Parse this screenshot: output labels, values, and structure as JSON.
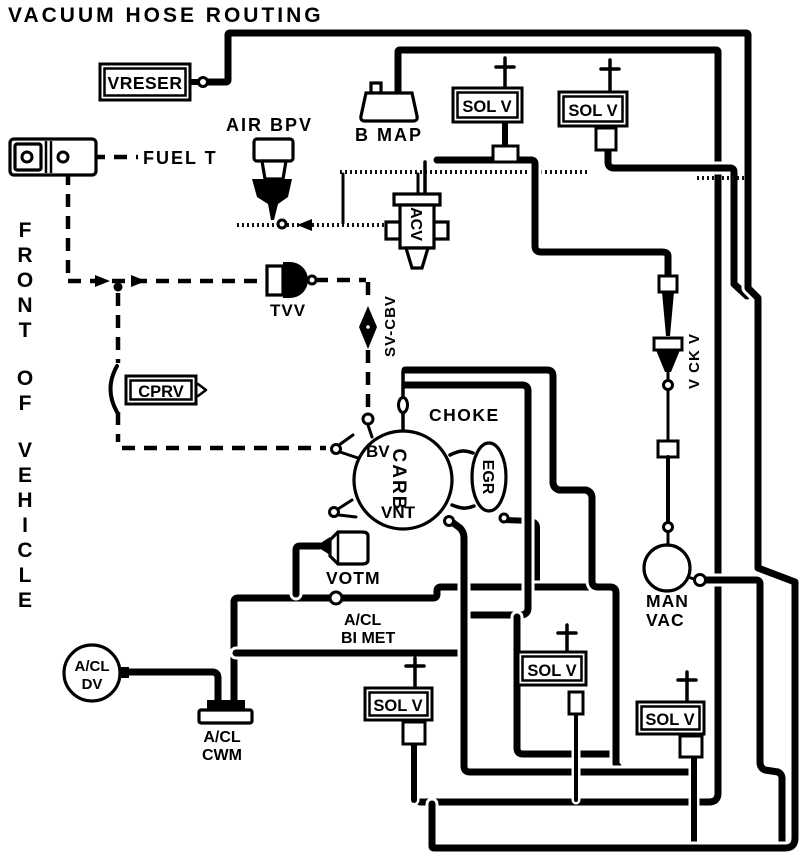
{
  "title": "VACUUM HOSE ROUTING",
  "orientation": {
    "words": [
      "FRONT",
      "OF",
      "VEHICLE"
    ]
  },
  "labels": {
    "vreser": "VRESER",
    "fuel_t": "FUEL T",
    "air_bpv": "AIR BPV",
    "b_map": "B MAP",
    "sol_v": "SOL V",
    "acv": "ACV",
    "tvv": "TVV",
    "cprv": "CPRV",
    "sv_cbv": "SV-CBV",
    "choke": "CHOKE",
    "bv": "BV",
    "carb": "CARB",
    "vnt": "VNT",
    "egr": "EGR",
    "votm": "VOTM",
    "acl": "A/CL",
    "bi_met": "BI MET",
    "dv": "DV",
    "cwm": "CWM",
    "man": "MAN",
    "vac": "VAC",
    "v_ck_v": "V CK V"
  },
  "colors": {
    "ink": "#000000",
    "paper": "#ffffff"
  }
}
